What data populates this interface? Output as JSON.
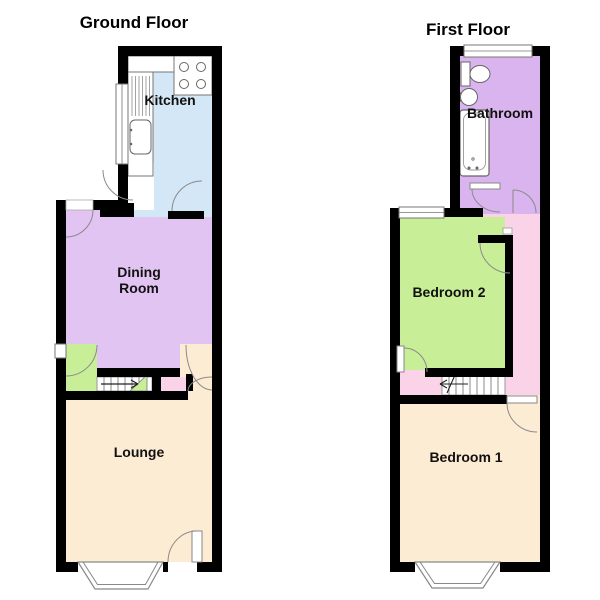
{
  "colors": {
    "background": "#ffffff",
    "wall": "#000000",
    "door_arc": "#8a8a8a",
    "kitchen": "#d4e7f6",
    "dining_room": "#e2c4f2",
    "lounge": "#fdecd4",
    "bathroom": "#d9b4ef",
    "bedroom2": "#c9ee98",
    "bedroom1": "#fdecd4",
    "landing": "#fbd3e9",
    "label_text": "#111111"
  },
  "floors": [
    {
      "title": "Ground Floor",
      "rooms": [
        {
          "label": "Kitchen",
          "lines": [
            "Kitchen"
          ]
        },
        {
          "label": "Dining Room",
          "lines": [
            "Dining",
            "Room"
          ]
        },
        {
          "label": "Lounge",
          "lines": [
            "Lounge"
          ]
        }
      ]
    },
    {
      "title": "First Floor",
      "rooms": [
        {
          "label": "Bathroom",
          "lines": [
            "Bathroom"
          ]
        },
        {
          "label": "Bedroom 2",
          "lines": [
            "Bedroom 2"
          ]
        },
        {
          "label": "Bedroom 1",
          "lines": [
            "Bedroom 1"
          ]
        }
      ]
    }
  ]
}
